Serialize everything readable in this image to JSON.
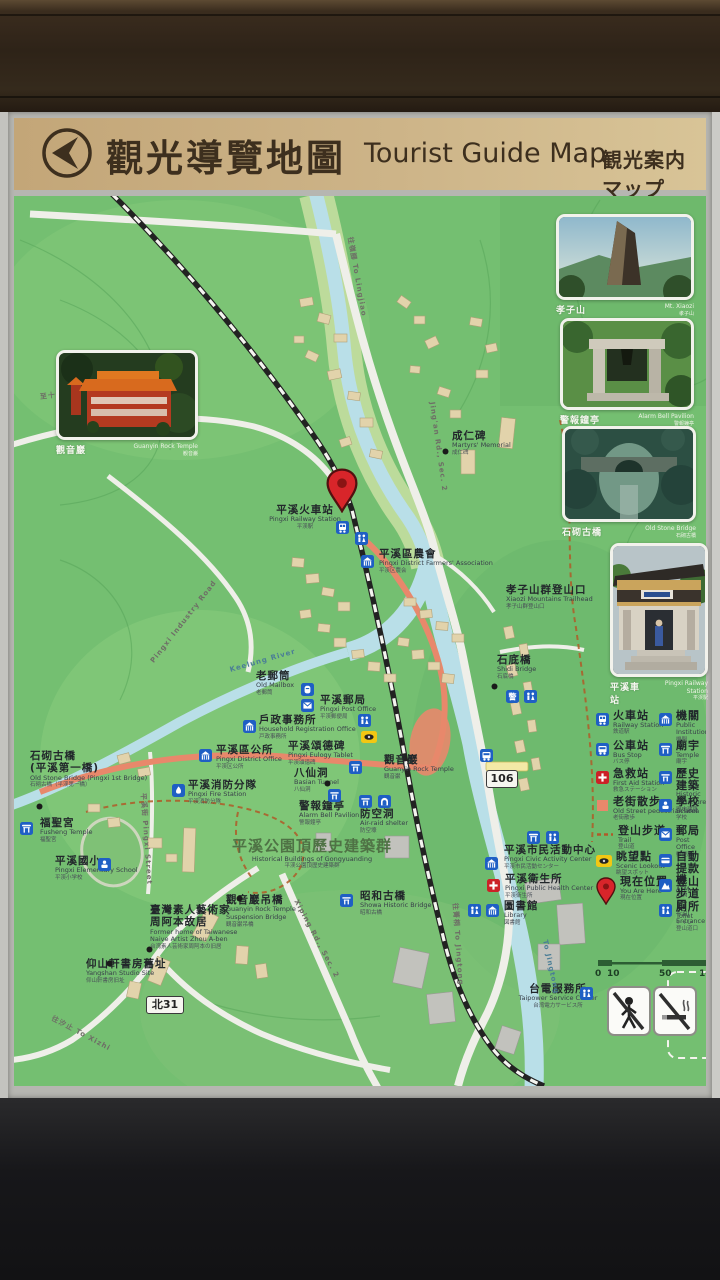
{
  "title": {
    "zh": "觀光導覽地圖",
    "en": "Tourist Guide Map",
    "jp": "観光案内マップ"
  },
  "photos": [
    {
      "id": "guanyin-temple",
      "zh": "觀音巖",
      "en": "Guanyin Rock Temple",
      "jp": "観音巌"
    },
    {
      "id": "mt-xiaozi",
      "zh": "孝子山",
      "en": "Mt. Xiaozi",
      "jp": "孝子山"
    },
    {
      "id": "alarm-bell-pavilion",
      "zh": "警報鐘亭",
      "en": "Alarm Bell Pavilion",
      "jp": "警報鐘亭"
    },
    {
      "id": "old-stone-bridge",
      "zh": "石砌古橋",
      "en": "Old Stone Bridge",
      "jp": "石砌古橋"
    },
    {
      "id": "pingxi-station",
      "zh": "平溪車站",
      "en": "Pingxi Railway Station",
      "jp": "平渓駅"
    }
  ],
  "poi": [
    {
      "id": "railway-station",
      "x": 305,
      "y": 504,
      "align": "center",
      "zh": "平溪火車站",
      "en": "Pingxi Railway Station",
      "jp": "平渓駅"
    },
    {
      "id": "farmers-association",
      "x": 379,
      "y": 548,
      "zh": "平溪區農會",
      "en": "Pingxi District Farmers' Association",
      "jp": "平渓区農会"
    },
    {
      "id": "martyrs-memorial",
      "x": 452,
      "y": 430,
      "zh": "成仁碑",
      "en": "Martyrs' Memorial",
      "jp": "成仁碑"
    },
    {
      "id": "xiaozi-trailhead",
      "x": 506,
      "y": 584,
      "zh": "孝子山群登山口",
      "en": "Xiaozi Mountains Trailhead",
      "jp": "孝子山群登山口"
    },
    {
      "id": "shidi-bridge",
      "x": 497,
      "y": 654,
      "zh": "石底橋",
      "en": "Shidi Bridge",
      "jp": "石底橋"
    },
    {
      "id": "old-mailbox",
      "x": 256,
      "y": 670,
      "zh": "老郵筒",
      "en": "Old Mailbox",
      "jp": "老郵筒"
    },
    {
      "id": "post-office",
      "x": 320,
      "y": 694,
      "zh": "平溪郵局",
      "en": "Pingxi Post Office",
      "jp": "平渓郵便局"
    },
    {
      "id": "household-registration",
      "x": 259,
      "y": 714,
      "zh": "戶政事務所",
      "en": "Household Registration Office",
      "jp": "戸政事務所"
    },
    {
      "id": "district-office",
      "x": 216,
      "y": 744,
      "zh": "平溪區公所",
      "en": "Pingxi District Office",
      "jp": "平渓区公所"
    },
    {
      "id": "fire-station",
      "x": 188,
      "y": 779,
      "zh": "平溪消防分隊",
      "en": "Pingxi Fire Station",
      "jp": "平渓消防分隊"
    },
    {
      "id": "eulogy-tablet",
      "x": 288,
      "y": 740,
      "zh": "平溪頌德碑",
      "en": "Pingxi Eulogy Tablet",
      "jp": "平渓頌徳碑"
    },
    {
      "id": "basian-tunnel",
      "x": 294,
      "y": 767,
      "zh": "八仙洞",
      "en": "Basian Tunnel",
      "jp": "八仙洞"
    },
    {
      "id": "guanyin-rock-temple",
      "x": 384,
      "y": 754,
      "zh": "觀音巖",
      "en": "Guanyin Rock Temple",
      "jp": "観音巌"
    },
    {
      "id": "alarm-bell",
      "x": 299,
      "y": 800,
      "zh": "警報鐘亭",
      "en": "Alarm Bell Pavilion",
      "jp": "警報鐘亭"
    },
    {
      "id": "air-raid-shelter",
      "x": 360,
      "y": 808,
      "zh": "防空洞",
      "en": "Air-raid shelter",
      "jp": "防空壕"
    },
    {
      "id": "gongyuanding",
      "x": 312,
      "y": 838,
      "align": "center",
      "zs": 15,
      "zc": "#4f7245",
      "zh": "平溪公園頂歷史建築群",
      "en": "Historical Buildings of Gongyuanding",
      "jp": "平渓公園頂歴史建築群"
    },
    {
      "id": "suspension-bridge",
      "x": 226,
      "y": 894,
      "zh": "觀音巖吊橋",
      "en": "Guanyin Rock Temple\nSuspension Bridge",
      "jp": "観音巌吊橋"
    },
    {
      "id": "showa-bridge",
      "x": 360,
      "y": 890,
      "zh": "昭和古橋",
      "en": "Showa Historic Bridge",
      "jp": "昭和古橋"
    },
    {
      "id": "civic-activity-center",
      "x": 504,
      "y": 844,
      "zh": "平溪市民活動中心",
      "en": "Pingxi Civic Activity Center",
      "jp": "平渓市民活動センター"
    },
    {
      "id": "public-health-center",
      "x": 505,
      "y": 873,
      "zh": "平溪衛生所",
      "en": "Pingxi Public Health Center",
      "jp": "平渓衛生所"
    },
    {
      "id": "library",
      "x": 504,
      "y": 900,
      "zh": "圖書館",
      "en": "Library",
      "jp": "図書館"
    },
    {
      "id": "taipower",
      "x": 558,
      "y": 983,
      "align": "center",
      "zh": "台電服務所",
      "en": "Taipower Service Center",
      "jp": "台湾電力サービス所"
    },
    {
      "id": "old-stone-bridge-west",
      "x": 30,
      "y": 750,
      "zh": "石砌古橋\n(平溪第一橋)",
      "en": "Old Stone Bridge (Pingxi 1st Bridge)",
      "jp": "石砌古橋（平渓第一橋）"
    },
    {
      "id": "fusheng-temple",
      "x": 40,
      "y": 817,
      "zh": "福聖宮",
      "en": "Fusheng Temple",
      "jp": "福聖宮"
    },
    {
      "id": "elementary-school",
      "x": 55,
      "y": 855,
      "zh": "平溪國小",
      "en": "Pingxi Elementary School",
      "jp": "平渓小学校"
    },
    {
      "id": "zhou-aben-home",
      "x": 150,
      "y": 904,
      "zh": "臺灣素人藝術家\n周阿本故居",
      "en": "Former home of Taiwanese\nNaive Artist Zhou A-ben",
      "jp": "台湾素人芸術家周阿本の旧居"
    },
    {
      "id": "yangshan-studio",
      "x": 86,
      "y": 958,
      "zh": "仰山軒書房舊址",
      "en": "Yangshan Studio Site",
      "jp": "仰山軒書房旧址"
    }
  ],
  "road_labels": [
    {
      "id": "to-shifen",
      "text": "至十分 To Shifen via Lingjiao",
      "x": 40,
      "y": 392,
      "rot": -7
    },
    {
      "id": "to-lingjiao",
      "text": "往嶺腳 To Lingjiao",
      "x": 350,
      "y": 232,
      "rot": 80
    },
    {
      "id": "jingan-rd",
      "text": "Jing'an Rd., Sec. 2",
      "x": 432,
      "y": 398,
      "rot": 82
    },
    {
      "id": "pingxi-industry-rd",
      "text": "Pingxi Industry Road",
      "x": 152,
      "y": 658,
      "rot": -52
    },
    {
      "id": "pingxi-street",
      "text": "平溪街 Pingxi Street",
      "x": 143,
      "y": 788,
      "rot": 86
    },
    {
      "id": "xiping-rd",
      "text": "Xiping Rd., Sec. 2",
      "x": 296,
      "y": 896,
      "rot": 62
    },
    {
      "id": "to-jingtong-road",
      "text": "往菁桐 To Jingtong",
      "x": 455,
      "y": 898,
      "rot": 86
    },
    {
      "id": "to-jingtong-river",
      "text": "To Jingtong",
      "x": 545,
      "y": 936,
      "rot": 78,
      "color": "#4a7d96"
    },
    {
      "id": "to-xizhi",
      "text": "往汐止 To Xizhi",
      "x": 52,
      "y": 1013,
      "rot": 28
    },
    {
      "id": "keelung-river",
      "text": "Keelung River",
      "x": 230,
      "y": 666,
      "rot": -16,
      "color": "#4a7d96"
    }
  ],
  "shields": [
    {
      "id": "route-106",
      "text": "106",
      "x": 486,
      "y": 770,
      "w": 30,
      "h": 16,
      "fs": 11
    },
    {
      "id": "route-north-31",
      "text": "北31",
      "x": 146,
      "y": 996,
      "w": 36,
      "h": 16,
      "fs": 11
    }
  ],
  "map_icons": [
    {
      "t": "pin",
      "x": 326,
      "y": 468,
      "big": true
    },
    {
      "t": "train",
      "x": 336,
      "y": 519
    },
    {
      "t": "toilet",
      "x": 355,
      "y": 530
    },
    {
      "t": "inst",
      "x": 361,
      "y": 553
    },
    {
      "t": "dot",
      "x": 442,
      "y": 440
    },
    {
      "t": "dot",
      "x": 491,
      "y": 675
    },
    {
      "t": "police",
      "x": 506,
      "y": 688
    },
    {
      "t": "toilet",
      "x": 524,
      "y": 688
    },
    {
      "t": "mailbox",
      "x": 301,
      "y": 681
    },
    {
      "t": "post",
      "x": 301,
      "y": 697
    },
    {
      "t": "inst",
      "x": 243,
      "y": 718
    },
    {
      "t": "inst",
      "x": 199,
      "y": 747
    },
    {
      "t": "fire",
      "x": 172,
      "y": 782
    },
    {
      "t": "historic",
      "x": 349,
      "y": 759
    },
    {
      "t": "dot",
      "x": 324,
      "y": 772
    },
    {
      "t": "eye",
      "x": 361,
      "y": 728
    },
    {
      "t": "historic",
      "x": 328,
      "y": 787
    },
    {
      "t": "historic",
      "x": 359,
      "y": 793
    },
    {
      "t": "tunnel",
      "x": 378,
      "y": 793
    },
    {
      "t": "dot",
      "x": 236,
      "y": 887
    },
    {
      "t": "historic",
      "x": 340,
      "y": 892
    },
    {
      "t": "inst",
      "x": 485,
      "y": 855
    },
    {
      "t": "firstaid",
      "x": 487,
      "y": 877
    },
    {
      "t": "toilet",
      "x": 468,
      "y": 902
    },
    {
      "t": "inst",
      "x": 486,
      "y": 902
    },
    {
      "t": "toilet",
      "x": 580,
      "y": 985
    },
    {
      "t": "dot",
      "x": 36,
      "y": 795
    },
    {
      "t": "temple",
      "x": 20,
      "y": 820
    },
    {
      "t": "school",
      "x": 98,
      "y": 856
    },
    {
      "t": "dot",
      "x": 146,
      "y": 938
    },
    {
      "t": "dot",
      "x": 106,
      "y": 952
    },
    {
      "t": "bus",
      "x": 480,
      "y": 747
    },
    {
      "t": "temple",
      "x": 527,
      "y": 829
    },
    {
      "t": "toilet",
      "x": 546,
      "y": 829
    },
    {
      "t": "toilet",
      "x": 358,
      "y": 712
    }
  ],
  "legend": {
    "left": [
      {
        "icon": "train",
        "rail": true,
        "zh": "火車站",
        "en": "Railway Station",
        "jp": "鉄道駅",
        "y": 710
      },
      {
        "icon": "bus",
        "zh": "公車站",
        "en": "Bus Stop",
        "jp": "バス停",
        "y": 740
      },
      {
        "icon": "firstaid",
        "zh": "急救站",
        "en": "First Aid Station",
        "jp": "救急ステーション",
        "y": 768
      },
      {
        "icon": "oldstreet",
        "zh": "老街散步",
        "en": "Old Street pedestrian area",
        "jp": "老街散歩",
        "y": 796
      },
      {
        "icon": "traildash",
        "zh": "登山步道",
        "en": "Trail",
        "jp": "登山道",
        "y": 825
      },
      {
        "icon": "eye",
        "zh": "眺望點",
        "en": "Scenic Lookout",
        "jp": "眺望スポット",
        "y": 851
      },
      {
        "icon": "pin",
        "zh": "現在位置",
        "en": "You Are Here",
        "jp": "現在位置",
        "y": 876
      }
    ],
    "right": [
      {
        "icon": "inst",
        "zh": "機關",
        "en": "Public Institution",
        "jp": "機関",
        "y": 710
      },
      {
        "icon": "temple",
        "zh": "廟宇",
        "en": "Temple",
        "jp": "廟宇",
        "y": 740
      },
      {
        "icon": "historic",
        "zh": "歷史建築",
        "en": "Historic Structure",
        "jp": "歴史建築",
        "y": 768
      },
      {
        "icon": "school",
        "zh": "學校",
        "en": "School",
        "jp": "学校",
        "y": 796
      },
      {
        "icon": "post",
        "zh": "郵局",
        "en": "Post Office",
        "jp": "郵便局",
        "y": 825
      },
      {
        "icon": "atm",
        "zh": "自動提款機",
        "en": "ATM",
        "jp": "ATM",
        "y": 851
      },
      {
        "icon": "trailent",
        "zh": "登山步道口",
        "en": "Trail Entrance",
        "jp": "登山道口",
        "y": 876
      },
      {
        "icon": "toilet",
        "zh": "廁所",
        "en": "Toilet",
        "jp": "トイレ",
        "y": 901
      }
    ]
  },
  "scale": {
    "ticks": [
      {
        "t": "0",
        "x": 598
      },
      {
        "t": "10",
        "x": 610
      },
      {
        "t": "50",
        "x": 662
      },
      {
        "t": "100",
        "x": 702
      }
    ]
  },
  "prohibition_signs": [
    {
      "id": "no-pedestrian",
      "x": 607,
      "y": 986
    },
    {
      "id": "no-smoking",
      "x": 653,
      "y": 986
    }
  ]
}
